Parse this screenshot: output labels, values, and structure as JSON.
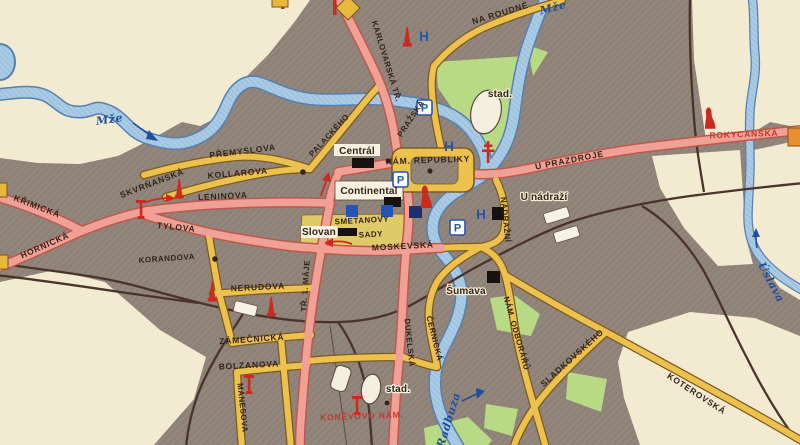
{
  "map": {
    "title": "Plzeň city centre map (vintage)",
    "labels": {
      "mze": "Mže",
      "radbuza": "Radbuza",
      "uslava": "Úslava",
      "na_roudne": "NA ROUDNÉ",
      "karlovarska": "KARLOVARSKÁ TŘ.",
      "rokycanska": "ROKYCANSKÁ",
      "prazska": "PRAŽSKÁ",
      "palackeho": "PALACKÉHO",
      "premyslova": "PŘEMYSLOVA",
      "kollarova": "KOLLAROVA",
      "skvrnanska": "SKVRŇANSKÁ",
      "krimicka": "KŘIMICKÁ",
      "hornicka": "HORNICKÁ",
      "leninova": "LENINOVA",
      "tylova": "TYLOVA",
      "korandova": "KORANDOVA",
      "tr_1_maje": "TŘ. 1. MÁJE",
      "smetanovy": "SMETANOVY",
      "sady": "SADY",
      "moskevska": "MOSKEVSKÁ",
      "nerudova": "NERUDOVA",
      "zamecnicka": "ZÁMEČNICKÁ",
      "bolzanova": "BOLZANOVA",
      "manesova": "MÁNESOVA",
      "dukelska": "DUKELSKÁ",
      "cernicka": "ČERNICKÁ",
      "konevovo_nam": "KONĚVOVO NÁM.",
      "nam_republiky": "NÁM. REPUBLIKY",
      "u_prazdroje": "U PRAZDROJE",
      "u_nadrazi": "U nádraží",
      "nadrazni": "NÁDRAŽNÍ",
      "nam_odboraru": "NÁM. ODBORÁŘŮ",
      "sladkovskeho": "SLADKOVSKÉHO",
      "koterovska": "KOTEROVSKÁ",
      "central": "Centrál",
      "continental": "Continental",
      "slovan": "Slovan",
      "sumava": "Šumava",
      "stad": "stad."
    },
    "icons": {
      "parking": "P",
      "hotel": "H"
    },
    "colors": {
      "built_area": "#8e8177",
      "open_area": "#f3ead2",
      "main_road": "#f0a095",
      "secondary_road": "#ecc14d",
      "river": "#aacbe4",
      "park": "#b9da85",
      "railway": "#4a332a",
      "monument_red": "#cc2a1e",
      "amenity_blue": "#2356b2",
      "river_label_blue": "#1d4f9e",
      "red_label": "#c5372a"
    }
  }
}
